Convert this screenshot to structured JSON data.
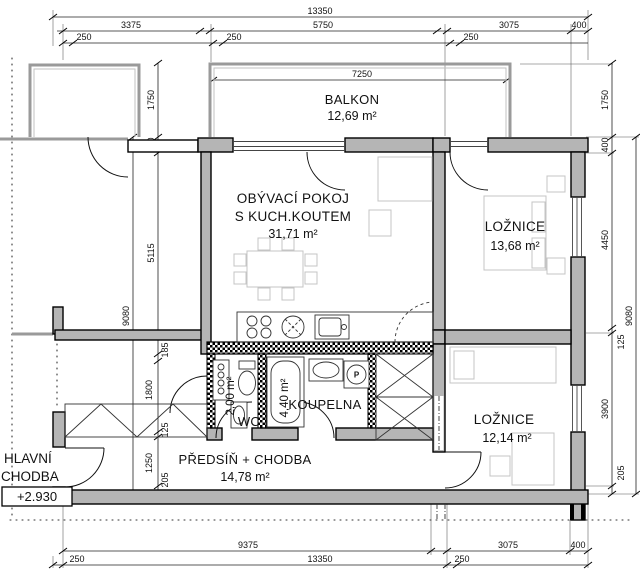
{
  "plan": {
    "rooms": {
      "balkon": {
        "name": "BALKON",
        "area": "12,69 m²"
      },
      "obyvaci_pokoj": {
        "name_line1": "OBÝVACÍ POKOJ",
        "name_line2": "S KUCH.KOUTEM",
        "area": "31,71 m²"
      },
      "loznice_1": {
        "name": "LOŽNICE",
        "area": "13,68 m²"
      },
      "loznice_2": {
        "name": "LOŽNICE",
        "area": "12,14 m²"
      },
      "koupelna": {
        "name": "KOUPELNA",
        "area": "4,40 m²"
      },
      "wc": {
        "name": "WC",
        "area": "2,00 m²"
      },
      "predsin": {
        "name": "PŘEDSÍŇ + CHODBA",
        "area": "14,78 m²"
      },
      "hlavni_chodba": {
        "name_line1": "HLAVNÍ",
        "name_line2": "CHODBA",
        "elevation": "+2.930"
      }
    },
    "symbols": {
      "washing_machine": "P"
    }
  },
  "dimensions": {
    "top": {
      "total": "13350",
      "segments": [
        "3375",
        "5750",
        "3075",
        "400"
      ],
      "offsets": [
        "250",
        "250",
        "250"
      ]
    },
    "balkon_width": "7250",
    "bottom": {
      "segments": [
        "9375",
        "3075",
        "400"
      ],
      "offsets": [
        "250",
        "13350",
        "250"
      ]
    },
    "left": {
      "overall": "9080",
      "chain": [
        "1750",
        "400",
        "5115",
        "185",
        "1800",
        "125",
        "1250",
        "205"
      ]
    },
    "right": {
      "overall": "9080",
      "chain": [
        "1750",
        "400",
        "4450",
        "125",
        "3900",
        "205"
      ]
    }
  },
  "colors": {
    "wall_fill": "#b5b5b5",
    "wall_stroke": "#000000",
    "neighbor_wall": "#9a9a9a",
    "furniture": "#c4c4c4"
  }
}
